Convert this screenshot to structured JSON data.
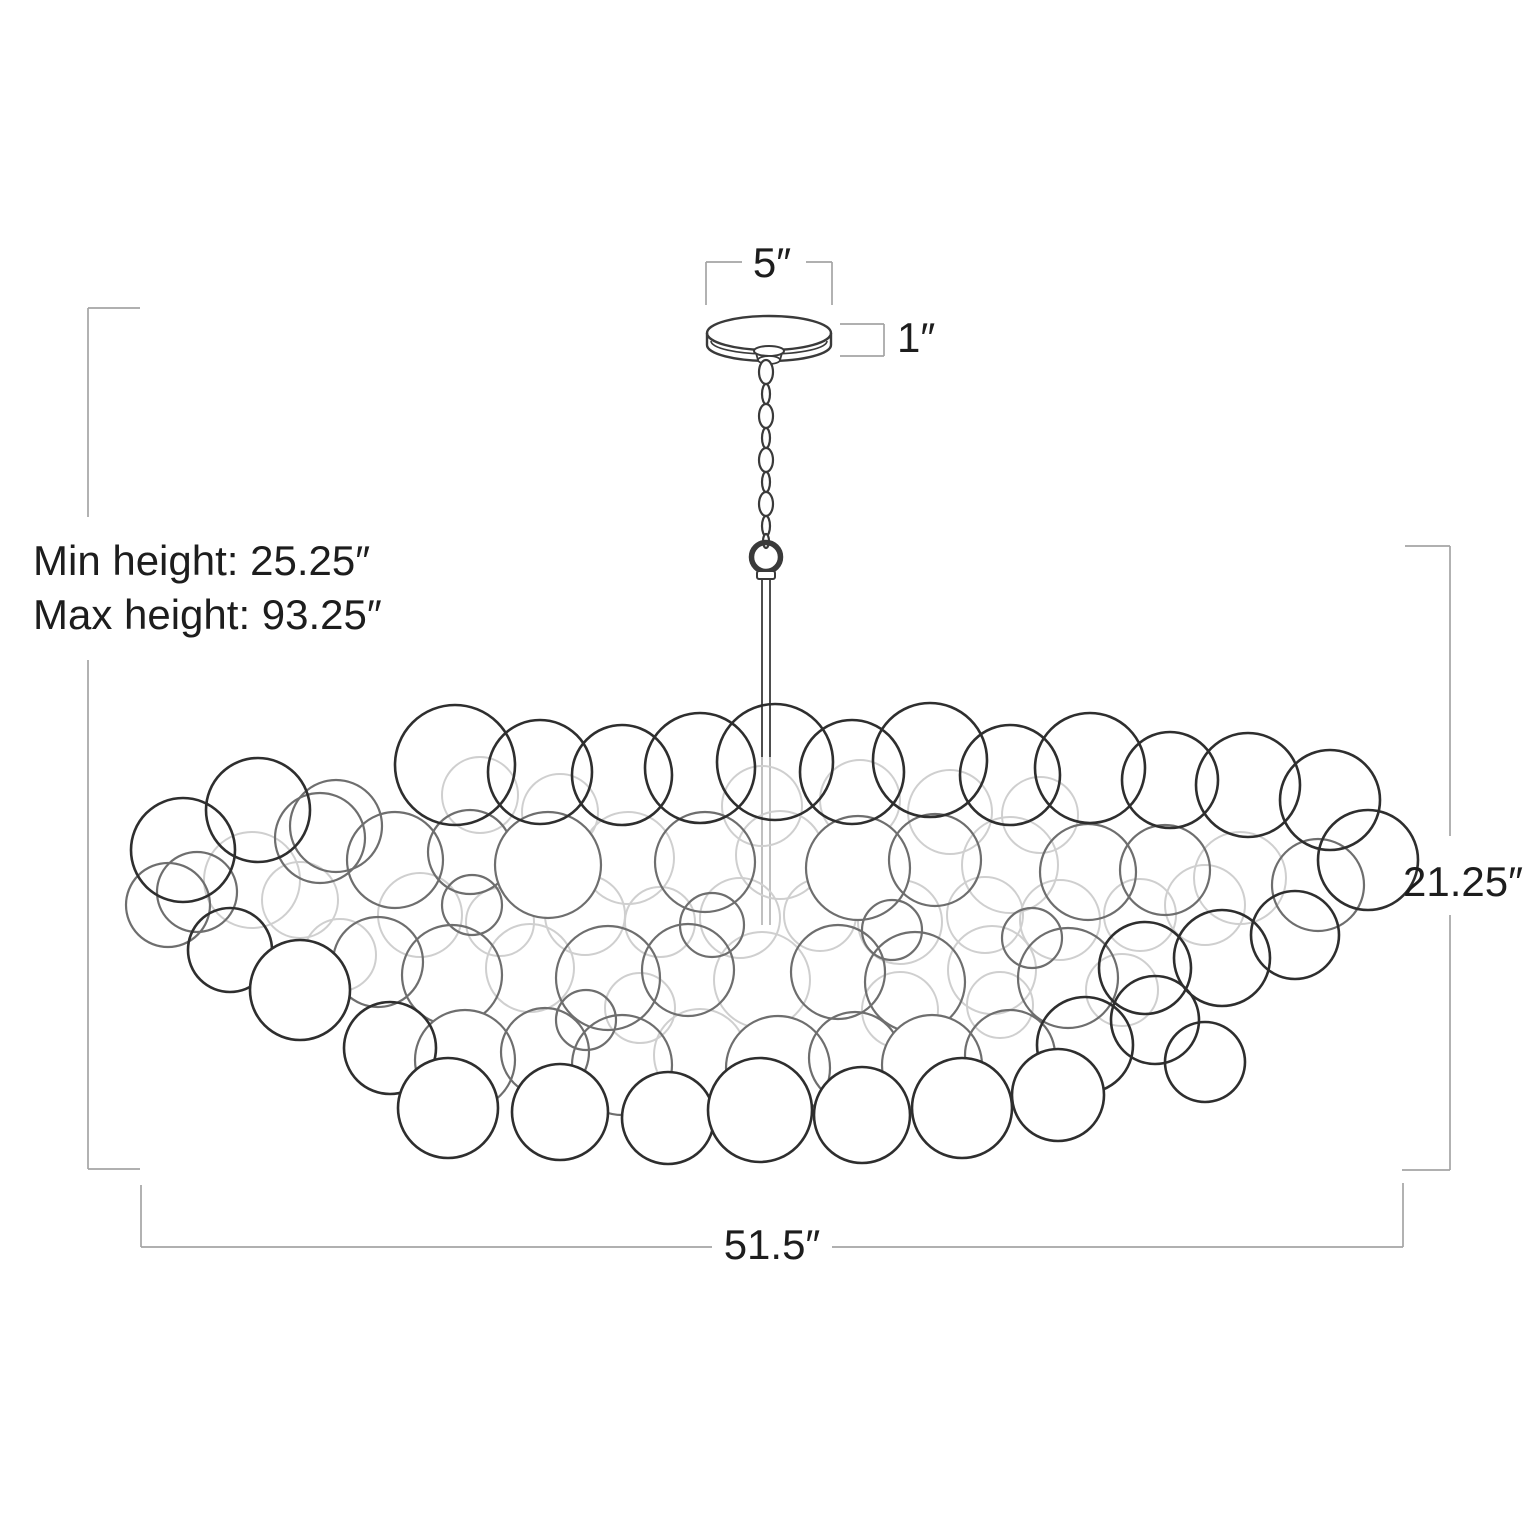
{
  "page": {
    "title": "Chandelier dimension diagram",
    "background": "#ffffff"
  },
  "labels": [
    {
      "id": "canopy-width",
      "text": "5″",
      "x": 772,
      "y": 277,
      "anchor": "middle"
    },
    {
      "id": "canopy-height",
      "text": "1″",
      "x": 897,
      "y": 352,
      "anchor": "start"
    },
    {
      "id": "min-height",
      "text": "Min height: 25.25″",
      "x": 33,
      "y": 575,
      "anchor": "start"
    },
    {
      "id": "max-height",
      "text": "Max height: 93.25″",
      "x": 33,
      "y": 629,
      "anchor": "start"
    },
    {
      "id": "fixture-height",
      "text": "21.25″",
      "x": 1463,
      "y": 896,
      "anchor": "middle"
    },
    {
      "id": "fixture-width",
      "text": "51.5″",
      "x": 772,
      "y": 1259,
      "anchor": "middle"
    }
  ],
  "styles": {
    "dim_line_color": "#a5a5a5",
    "dim_line_width": 1.7,
    "text_color": "#1d1d1d",
    "font_size": 42,
    "ink": "#3a3a3a",
    "ink_width": 2.4,
    "rod_faint": "#b9b9b9",
    "shades": {
      "d": "#2e2e2e",
      "m": "#6e6e6e",
      "l": "#cfcfcf"
    },
    "stroke_widths": {
      "d": 2.6,
      "m": 2.2,
      "l": 2.0
    }
  },
  "diagram": {
    "canvas": {
      "w": 1536,
      "h": 1536
    },
    "brackets": {
      "left_height": [
        [
          88,
          308,
          140,
          308
        ],
        [
          88,
          308,
          88,
          517
        ],
        [
          88,
          660,
          88,
          1169
        ],
        [
          88,
          1169,
          140,
          1169
        ]
      ],
      "right_height": [
        [
          1405,
          546,
          1450,
          546
        ],
        [
          1450,
          546,
          1450,
          836
        ],
        [
          1450,
          915,
          1450,
          1170
        ],
        [
          1402,
          1170,
          1450,
          1170
        ]
      ],
      "top_width": [
        [
          706,
          262,
          742,
          262
        ],
        [
          806,
          262,
          832,
          262
        ],
        [
          706,
          262,
          706,
          305
        ],
        [
          832,
          262,
          832,
          305
        ]
      ],
      "canopy_side": [
        [
          840,
          324,
          884,
          324
        ],
        [
          884,
          324,
          884,
          356
        ],
        [
          840,
          356,
          884,
          356
        ]
      ],
      "bottom_width": [
        [
          141,
          1185,
          141,
          1247
        ],
        [
          141,
          1247,
          712,
          1247
        ],
        [
          832,
          1247,
          1403,
          1247
        ],
        [
          1403,
          1183,
          1403,
          1247
        ]
      ]
    },
    "canopy": {
      "cx": 769,
      "cy": 333,
      "rx": 62,
      "ry": 17,
      "side_bottom": 345,
      "bottom_ry": 16,
      "rim_y": 341,
      "rim_ry": 13,
      "hub": {
        "cx": 769,
        "cy": 351,
        "rx": 15,
        "ry": 5,
        "bottom_cy": 360,
        "bottom_rx": 11,
        "bottom_ry": 4
      }
    },
    "chain": {
      "cx": 766,
      "links": [
        [
          372,
          7,
          12
        ],
        [
          394,
          4,
          10
        ],
        [
          416,
          7,
          12
        ],
        [
          438,
          4,
          10
        ],
        [
          460,
          7,
          12
        ],
        [
          482,
          4,
          10
        ],
        [
          504,
          7,
          12
        ],
        [
          526,
          4,
          10
        ],
        [
          541,
          3,
          7
        ]
      ]
    },
    "ring": {
      "cx": 766,
      "cy": 557,
      "r": 14.5,
      "sw": 5.5
    },
    "collar": {
      "x": 757,
      "y": 571,
      "w": 18,
      "h": 8
    },
    "rod": {
      "x1": 762,
      "x2": 770,
      "y_top": 579,
      "y_dark_end": 757,
      "y_end": 925
    },
    "bubbles": [
      [
        300,
        900,
        38,
        "l",
        0
      ],
      [
        420,
        915,
        42,
        "l",
        0
      ],
      [
        500,
        922,
        34,
        "l",
        0
      ],
      [
        585,
        915,
        40,
        "l",
        0
      ],
      [
        660,
        922,
        35,
        "l",
        0
      ],
      [
        740,
        918,
        40,
        "l",
        0
      ],
      [
        820,
        915,
        36,
        "l",
        0
      ],
      [
        900,
        922,
        42,
        "l",
        0
      ],
      [
        985,
        915,
        38,
        "l",
        0
      ],
      [
        1060,
        920,
        40,
        "l",
        0
      ],
      [
        1140,
        915,
        36,
        "l",
        0
      ],
      [
        860,
        800,
        40,
        "l",
        0
      ],
      [
        950,
        812,
        42,
        "l",
        0
      ],
      [
        1040,
        815,
        38,
        "l",
        0
      ],
      [
        762,
        806,
        40,
        "l",
        0
      ],
      [
        560,
        812,
        38,
        "l",
        0
      ],
      [
        640,
        1008,
        35,
        "l",
        0
      ],
      [
        900,
        1010,
        38,
        "l",
        0
      ],
      [
        1000,
        1005,
        33,
        "l",
        0
      ],
      [
        340,
        955,
        36,
        "l",
        0
      ],
      [
        1205,
        905,
        40,
        "l",
        0
      ],
      [
        480,
        795,
        38,
        "l",
        0
      ],
      [
        252,
        880,
        48,
        "l",
        0
      ],
      [
        628,
        858,
        46,
        "l",
        0
      ],
      [
        780,
        855,
        44,
        "l",
        0
      ],
      [
        1010,
        865,
        48,
        "l",
        0
      ],
      [
        1240,
        878,
        46,
        "l",
        0
      ],
      [
        530,
        968,
        44,
        "l",
        0
      ],
      [
        762,
        980,
        48,
        "l",
        0
      ],
      [
        992,
        970,
        44,
        "l",
        0
      ],
      [
        700,
        1055,
        46,
        "l",
        0
      ],
      [
        1122,
        990,
        36,
        "l",
        0
      ],
      [
        336,
        826,
        46,
        "m",
        0
      ],
      [
        197,
        892,
        40,
        "m",
        0
      ],
      [
        168,
        905,
        42,
        "m",
        0
      ],
      [
        320,
        838,
        45,
        "m",
        0
      ],
      [
        395,
        860,
        48,
        "m",
        0
      ],
      [
        470,
        852,
        42,
        "m",
        0
      ],
      [
        548,
        865,
        53,
        "m",
        1
      ],
      [
        705,
        862,
        50,
        "m",
        0
      ],
      [
        858,
        868,
        52,
        "m",
        1
      ],
      [
        935,
        860,
        46,
        "m",
        0
      ],
      [
        1088,
        872,
        48,
        "m",
        0
      ],
      [
        1165,
        870,
        45,
        "m",
        0
      ],
      [
        1318,
        885,
        46,
        "m",
        0
      ],
      [
        378,
        962,
        45,
        "m",
        0
      ],
      [
        452,
        975,
        50,
        "m",
        0
      ],
      [
        608,
        978,
        52,
        "m",
        0
      ],
      [
        688,
        970,
        46,
        "m",
        0
      ],
      [
        838,
        972,
        47,
        "m",
        0
      ],
      [
        915,
        982,
        50,
        "m",
        0
      ],
      [
        1068,
        978,
        50,
        "m",
        0
      ],
      [
        465,
        1060,
        50,
        "m",
        1
      ],
      [
        545,
        1052,
        44,
        "m",
        0
      ],
      [
        622,
        1065,
        50,
        "m",
        0
      ],
      [
        778,
        1068,
        52,
        "m",
        1
      ],
      [
        855,
        1058,
        46,
        "m",
        0
      ],
      [
        932,
        1065,
        50,
        "m",
        1
      ],
      [
        1010,
        1055,
        45,
        "m",
        0
      ],
      [
        472,
        905,
        30,
        "m",
        0
      ],
      [
        712,
        925,
        32,
        "m",
        0
      ],
      [
        892,
        930,
        30,
        "m",
        0
      ],
      [
        1032,
        938,
        30,
        "m",
        0
      ],
      [
        586,
        1020,
        30,
        "m",
        0
      ],
      [
        183,
        850,
        52,
        "d",
        0
      ],
      [
        258,
        810,
        52,
        "d",
        0
      ],
      [
        455,
        765,
        60,
        "d",
        0
      ],
      [
        540,
        772,
        52,
        "d",
        0
      ],
      [
        622,
        775,
        50,
        "d",
        0
      ],
      [
        700,
        768,
        55,
        "d",
        0
      ],
      [
        775,
        762,
        58,
        "d",
        0
      ],
      [
        852,
        772,
        52,
        "d",
        0
      ],
      [
        930,
        760,
        57,
        "d",
        0
      ],
      [
        1010,
        775,
        50,
        "d",
        0
      ],
      [
        1090,
        768,
        55,
        "d",
        0
      ],
      [
        1170,
        780,
        48,
        "d",
        0
      ],
      [
        1248,
        785,
        52,
        "d",
        0
      ],
      [
        1330,
        800,
        50,
        "d",
        0
      ],
      [
        1368,
        860,
        50,
        "d",
        0
      ],
      [
        230,
        950,
        42,
        "d",
        0
      ],
      [
        300,
        990,
        50,
        "d",
        1
      ],
      [
        1145,
        968,
        46,
        "d",
        0
      ],
      [
        1222,
        958,
        48,
        "d",
        0
      ],
      [
        1295,
        935,
        44,
        "d",
        0
      ],
      [
        390,
        1048,
        46,
        "d",
        0
      ],
      [
        1085,
        1045,
        48,
        "d",
        0
      ],
      [
        1155,
        1020,
        44,
        "d",
        0
      ],
      [
        1205,
        1062,
        40,
        "d",
        0
      ],
      [
        448,
        1108,
        50,
        "d",
        1
      ],
      [
        560,
        1112,
        48,
        "d",
        1
      ],
      [
        668,
        1118,
        46,
        "d",
        1
      ],
      [
        760,
        1110,
        52,
        "d",
        1
      ],
      [
        862,
        1115,
        48,
        "d",
        1
      ],
      [
        962,
        1108,
        50,
        "d",
        1
      ],
      [
        1058,
        1095,
        46,
        "d",
        1
      ]
    ]
  }
}
